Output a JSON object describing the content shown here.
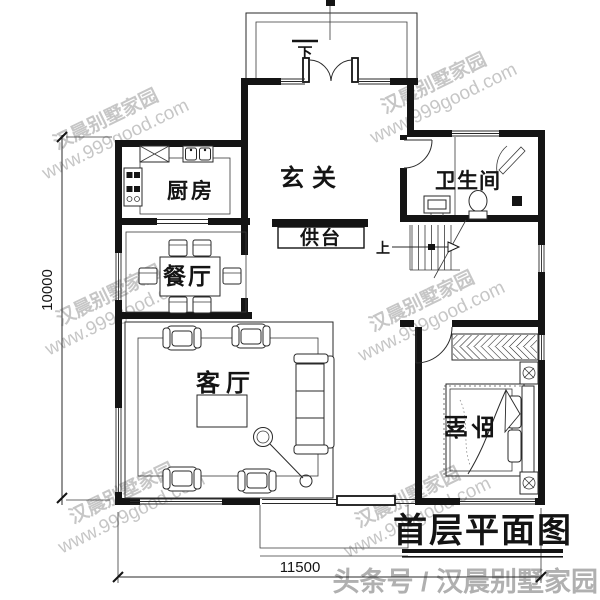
{
  "plan": {
    "title": "首层平面图",
    "rooms": {
      "kitchen": "厨房",
      "dining": "餐厅",
      "living": "客厅",
      "entry": "玄关",
      "altar": "供台",
      "bathroom": "卫生间",
      "bedroom": "卧室"
    },
    "stair_up_label": "上",
    "entry_down_label": "下",
    "dimensions": {
      "left_mm": "10000",
      "bottom_mm": "11500"
    }
  },
  "watermark": {
    "brand": "汉晨别墅家园",
    "site": "www.999good.com"
  },
  "footer": {
    "credit": "头条号 / 汉晨别墅家园"
  },
  "colors": {
    "ink": "#141414",
    "watermark": "#bdbdbd",
    "footer": "#b0b0b0",
    "background": "#ffffff"
  }
}
